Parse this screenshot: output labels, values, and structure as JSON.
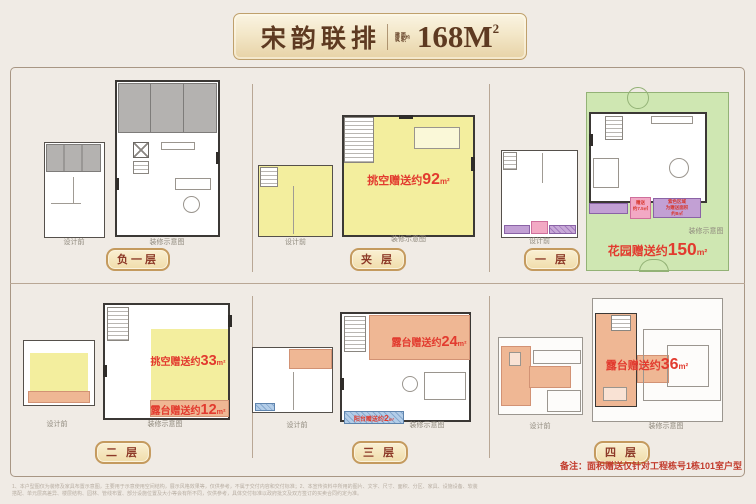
{
  "header": {
    "title": "宋韵联排",
    "seal_col1": "建筑",
    "seal_col2": "面积",
    "seal_small": "约",
    "area_value": "168M",
    "area_sup": "2"
  },
  "labels": {
    "before": "设计前",
    "after": "装修示意图"
  },
  "panels": [
    {
      "badge": "负一层"
    },
    {
      "badge": "夹 层",
      "void_gift": {
        "label": "挑空赠送约",
        "value": "92",
        "unit": "m²"
      }
    },
    {
      "badge": "一 层",
      "garden_gift": {
        "label": "花园赠送约",
        "value": "150",
        "unit": "m²"
      },
      "porch_gift": {
        "line1": "赠送",
        "line2": "约7.5㎡"
      },
      "purple_note": {
        "line1": "紫色区域",
        "line2": "为赠送面积",
        "line3": "约8㎡"
      }
    },
    {
      "badge": "二 层",
      "void_gift": {
        "label": "挑空赠送约",
        "value": "33",
        "unit": "m²"
      },
      "terrace_gift": {
        "label": "露台赠送约",
        "value": "12",
        "unit": "m²"
      }
    },
    {
      "badge": "三 层",
      "terrace_gift": {
        "label": "露台赠送约",
        "value": "24",
        "unit": "m²"
      },
      "balcony_gift": {
        "label": "阳台赠送约",
        "value": "2",
        "unit": "m²"
      }
    },
    {
      "badge": "四 层",
      "terrace_gift": {
        "label": "露台赠送约",
        "value": "36",
        "unit": "m²"
      }
    }
  ],
  "note": "备注：面积赠送仅针对工程栋号1栋101室户型",
  "disclaimer": {
    "line1": "1、本户型图仅为装修及家具布置示意图，主要用于示意使用空间结构，展示风格效果等，仅供参考，不属于交付内容和交付标准；2、本宣传资料中所用的图片、文字、尺寸、面积、分区、家具、设施设备、软装",
    "line2": "搭配、单元层高差异、楼层结构、园林、管线布置、部分设施位置及大小等会有所不同，仅供参考，具体交付标准以政府批文及双方签订的买卖合同约定为准。"
  },
  "colors": {
    "accent_red": "#e23b2f",
    "badge_border": "#c49a5e",
    "title_brown": "#5e3a21",
    "gift_yellow": "#f3ee9e",
    "garden_green": "#cfe7b2",
    "terrace_salmon": "#efb794",
    "gift_purple": "#c2a0d4",
    "gift_pink": "#f2a9c4",
    "balcony_blue": "#a9c7e5",
    "frame_line": "#a89684",
    "background": "#f0ebe5"
  }
}
